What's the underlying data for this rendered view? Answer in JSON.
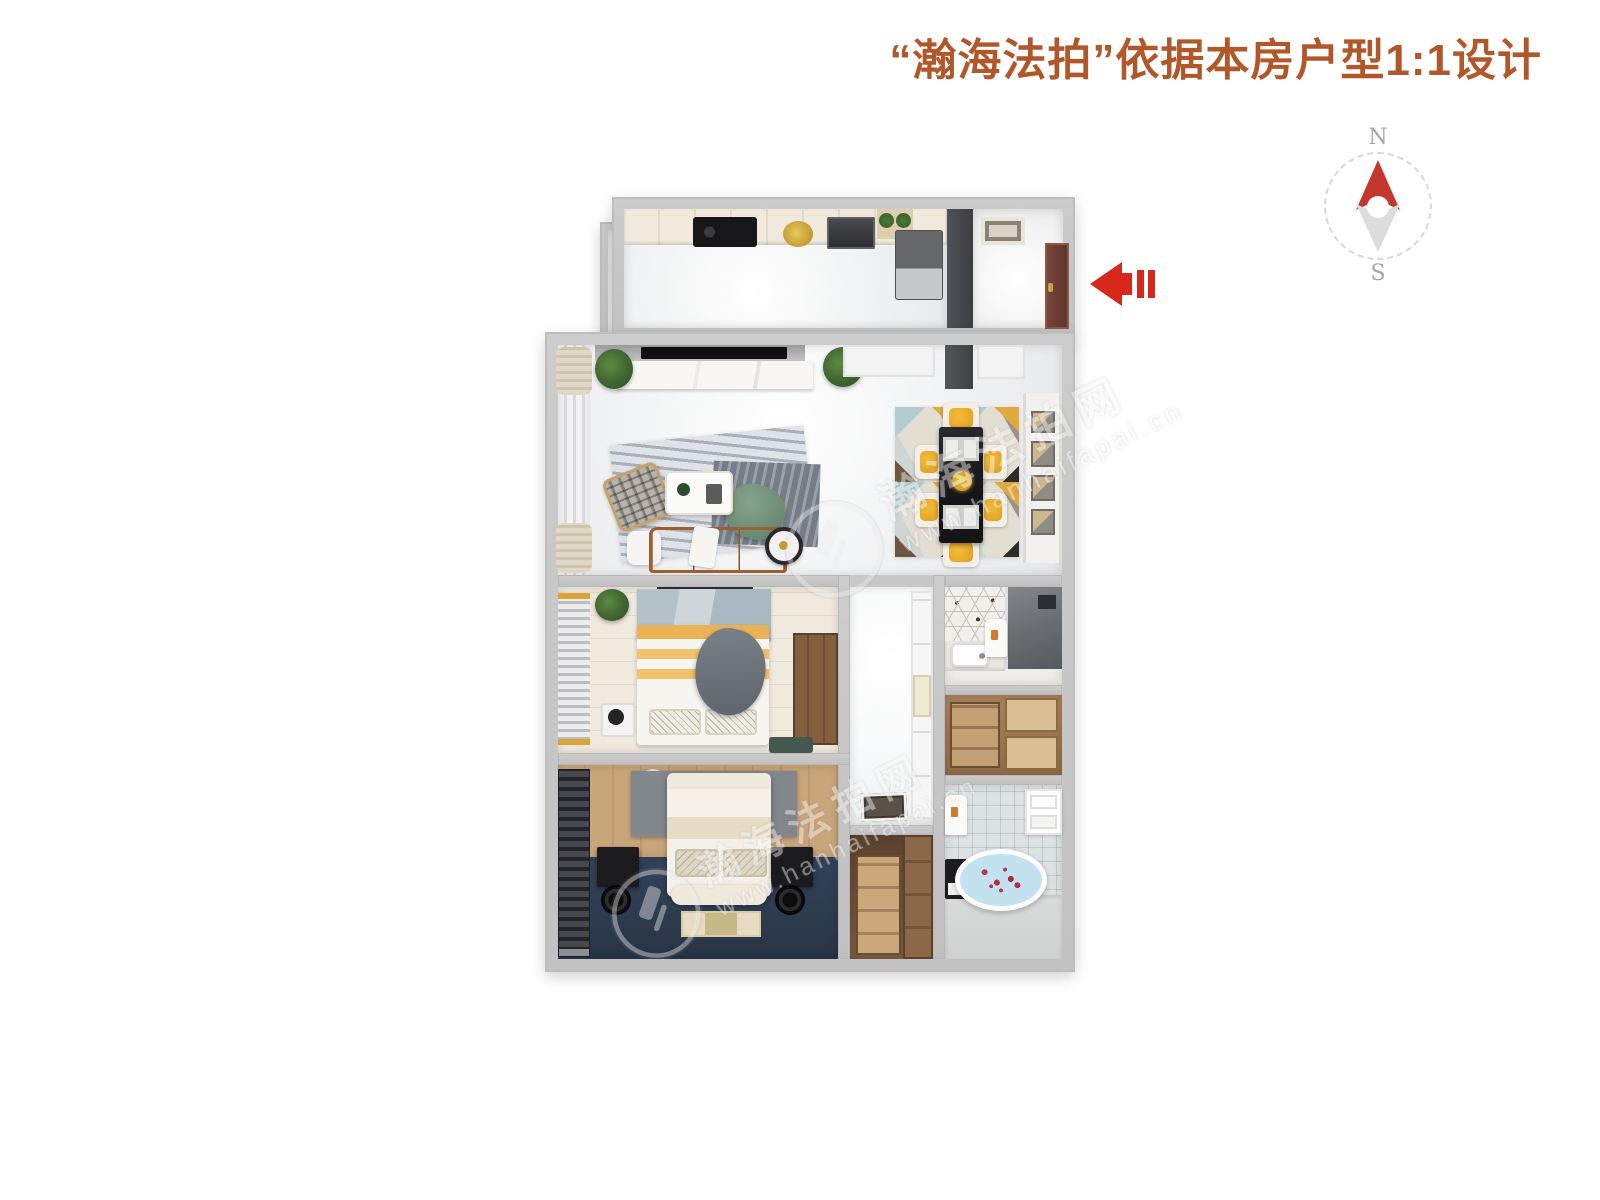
{
  "header": {
    "title": "“瀚海法拍”依据本房户型1:1设计",
    "title_color": "#b0582a"
  },
  "compass": {
    "north_label": "N",
    "south_label": "S",
    "needle_north_color": "#c4372c",
    "needle_south_color": "#dcdcdc",
    "ring_color": "#d8d8d8"
  },
  "entry_arrow": {
    "direction": "left",
    "color": "#d7281c"
  },
  "watermark": {
    "brand": "瀚海法拍网",
    "url": "www.hanhaifapai.cn"
  },
  "floorplan": {
    "wall_color": "#c6c6c6",
    "rooms": [
      {
        "name": "balcony",
        "floor": "#f0f0f0"
      },
      {
        "name": "kitchen",
        "floor": "#f0f1f2"
      },
      {
        "name": "entry-hall",
        "floor": "#f2f2f3",
        "door_color": "#6d3f33"
      },
      {
        "name": "living-dining-room",
        "floor": "#f1f2f3",
        "sofa": "#b06f3c",
        "dining_chairs": "#f5bd3a",
        "dining_table": "#1d1d1f"
      },
      {
        "name": "bedroom-2",
        "floor": "#efe9de",
        "bedding": "#eab254"
      },
      {
        "name": "corridor",
        "floor": "#f6f7f8"
      },
      {
        "name": "bathroom-1",
        "wall_tiles": "#f1efeb",
        "shower": "#6a6d71"
      },
      {
        "name": "storage-room",
        "wood": "#b18a5d"
      },
      {
        "name": "bathroom-2",
        "tiles": "#edf0f0",
        "bathtub_water": "#c2e2f0",
        "petals": "#c23545"
      },
      {
        "name": "bedroom-1",
        "floor": "#2d3b4e",
        "wood_wall": "#c9a57a",
        "bedding": "#f5f1e9"
      },
      {
        "name": "walk-in-closet",
        "wood": "#a8835a"
      }
    ]
  }
}
